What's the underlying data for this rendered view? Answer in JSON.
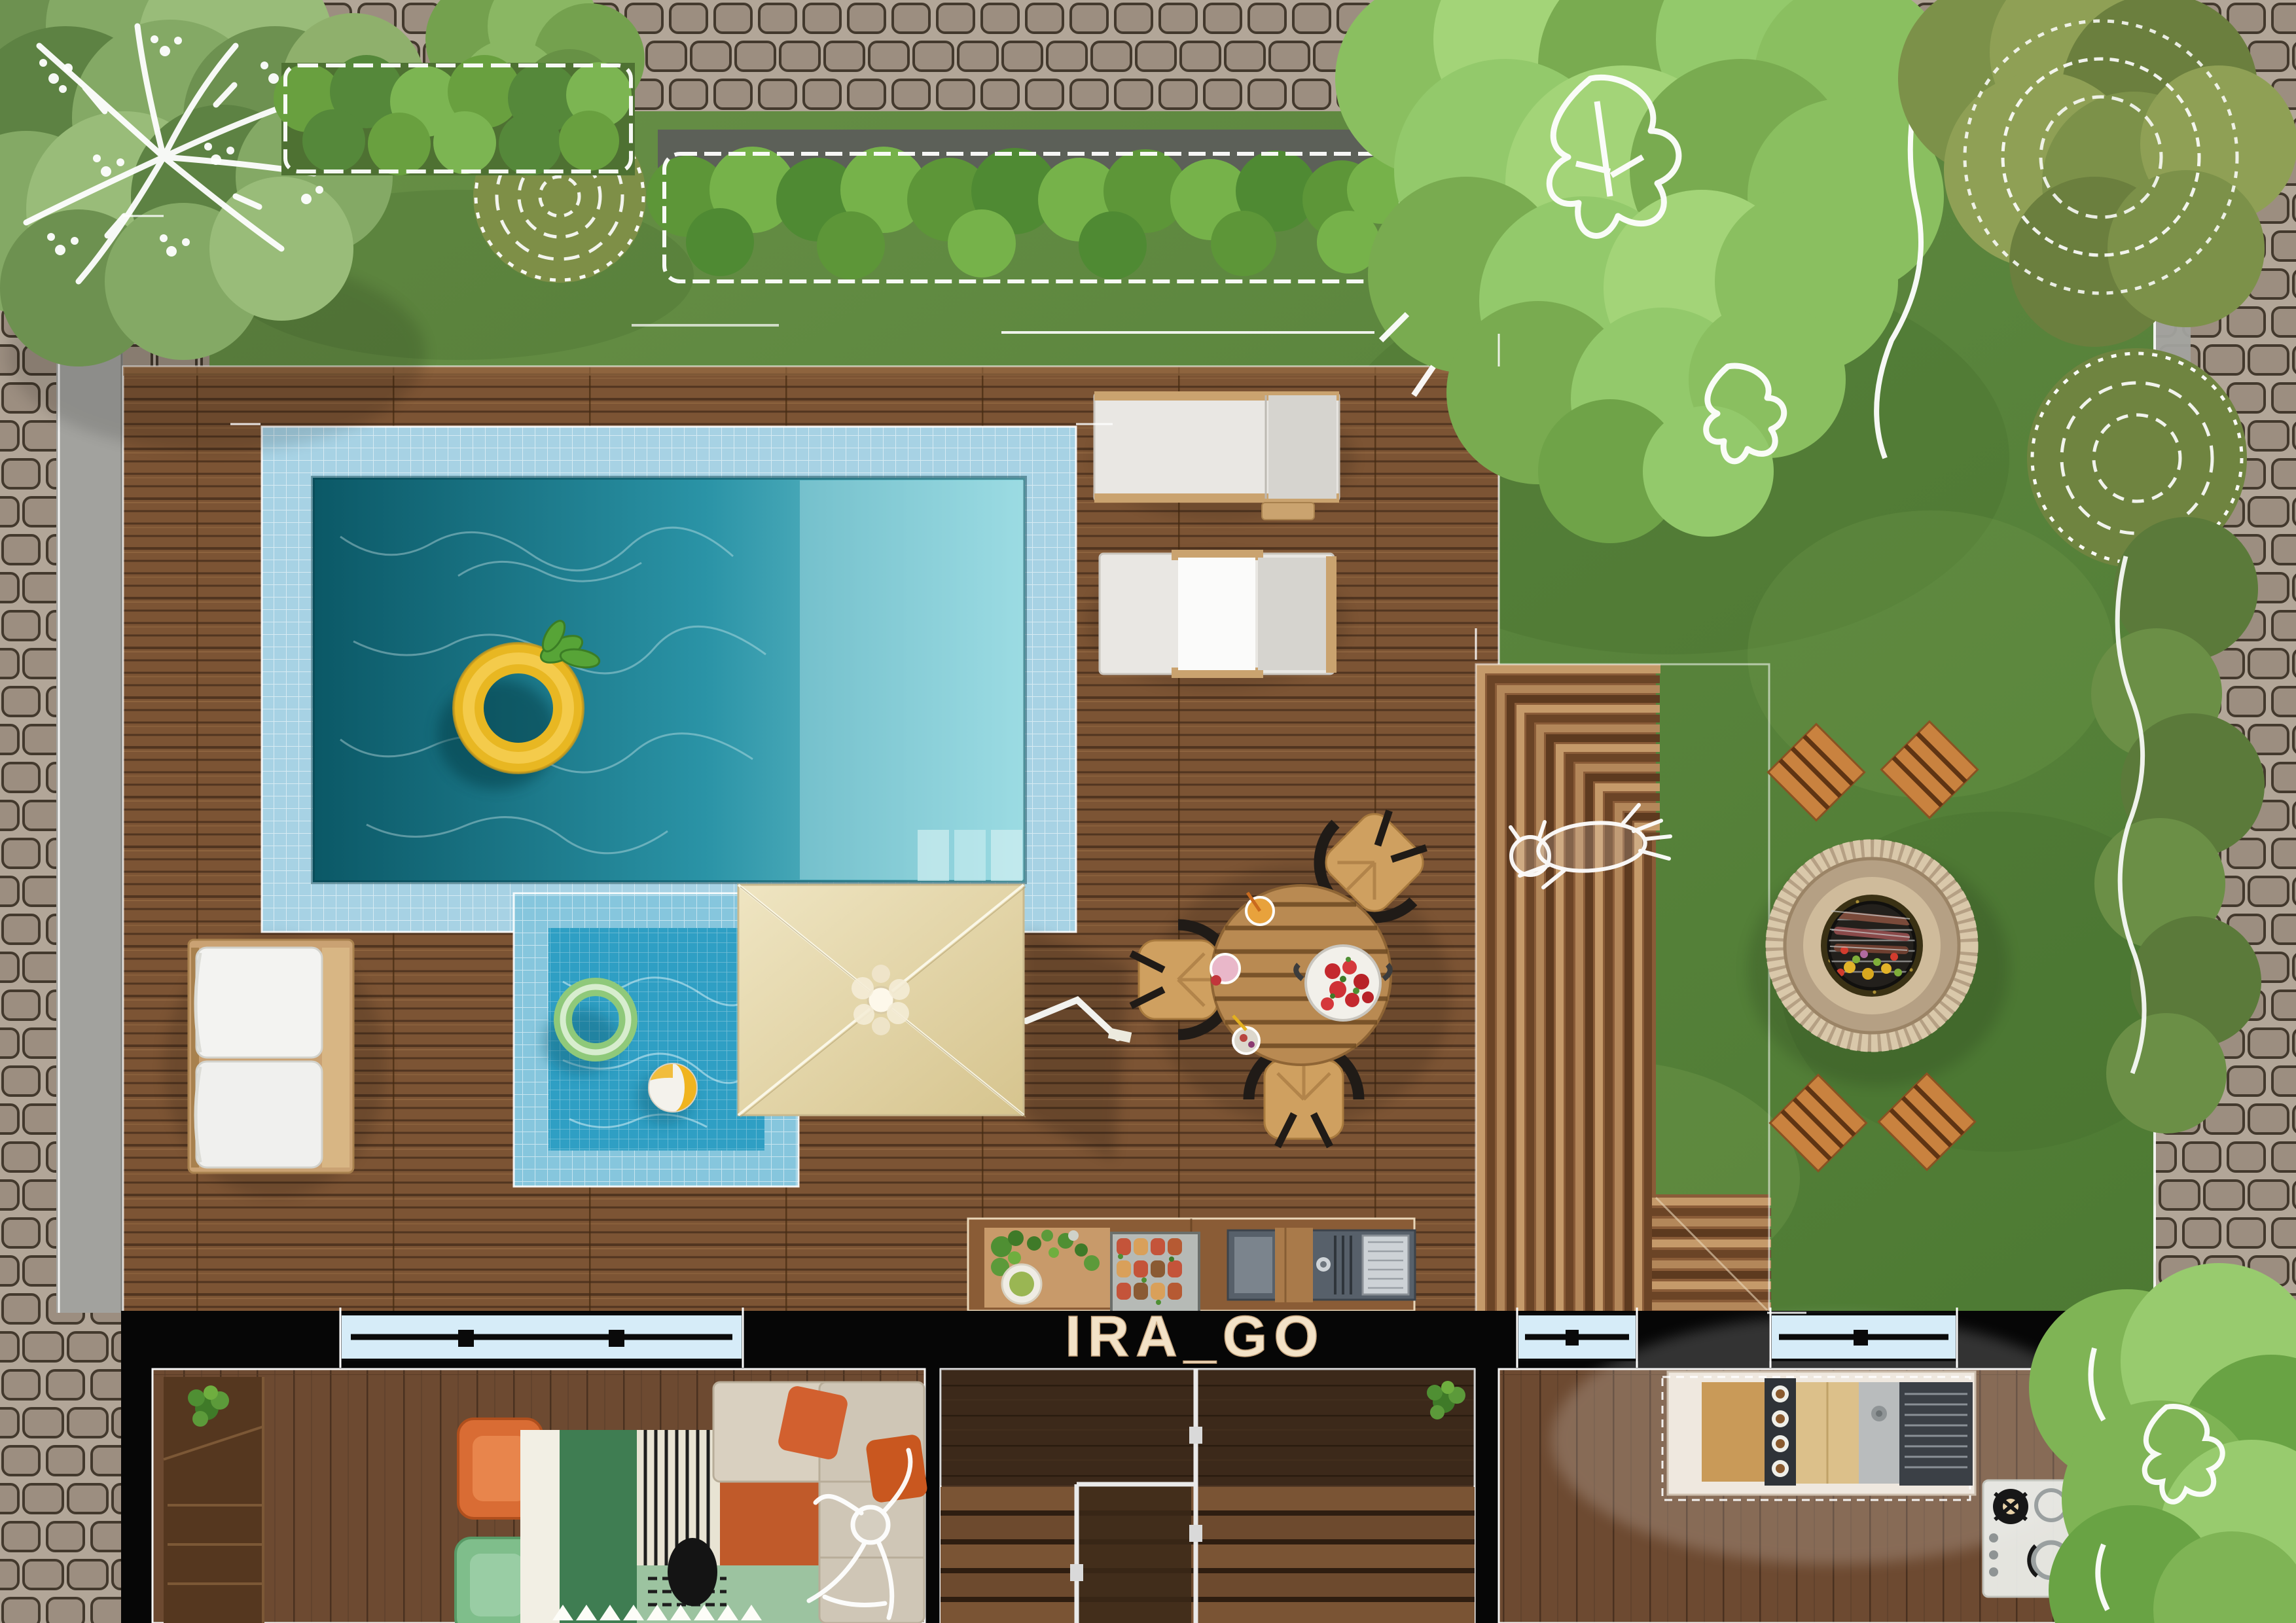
{
  "watermark": {
    "text": "IRA_GO"
  },
  "palette": {
    "cobbleBg": "#b2a698",
    "cobbleStone": "#9c8e80",
    "cobbleLine": "#43392d",
    "concrete": "#a2a29e",
    "lawnLight": "#678f46",
    "lawnDark": "#4d7a33",
    "deck": "#7c5434",
    "deckLine": "#513520",
    "poolTile": "#a7d2e4",
    "poolDeep": "#0b5866",
    "poolMid": "#2a93a6",
    "poolShallow": "#85d3dc",
    "kiddieWater": "#2f9fc4",
    "umbrella": "#e7dab0",
    "wall": "#060606",
    "windowGlass": "#d6ecf8",
    "cream": "#f3e2c7",
    "orangeAccent": "#d96c34",
    "greenChair": "#7fbe8b",
    "sofaBeige": "#d9d0c0",
    "firePitRing": "#cfbb9b",
    "stoolWood": "#c9823f",
    "tableWood": "#b98a52",
    "sketchWhite": "#ffffff"
  },
  "scene": {
    "objects": [
      "cobblestone-paving",
      "concrete-curb",
      "lawn",
      "wood-deck",
      "swimming-pool",
      "pineapple-float",
      "kids-pool",
      "green-ring-float",
      "beach-ball",
      "parasol",
      "sun-lounger",
      "sun-lounger",
      "outdoor-sofa",
      "dining-table-set",
      "strawberry-colander",
      "outdoor-kitchen-counter",
      "terraced-steps",
      "dog-sketch",
      "fire-pit-bbq",
      "fire-pit-stool",
      "fire-pit-stool",
      "fire-pit-stool",
      "fire-pit-stool",
      "house-living-room",
      "house-stair-hall",
      "house-kitchen",
      "window",
      "window",
      "window",
      "trees-and-hedges",
      "person-sketch"
    ]
  }
}
